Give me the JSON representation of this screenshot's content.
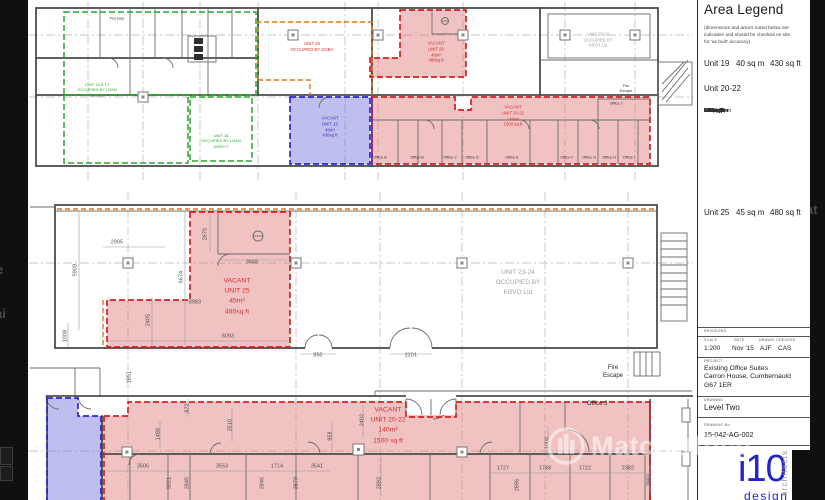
{
  "legend": {
    "title": "Area Legend",
    "disclaimer": "(dimensions and area's noted below are\nindicative and should be checked on site\nfor 'as built' accuracy)",
    "unit19": {
      "name": "Unit 19",
      "sqm": "40 sq m",
      "sqft": "430 sq ft"
    },
    "unit2022_heading": "Unit 20-22",
    "offices": [
      {
        "name": "Office A -",
        "sqm": "10.5 sq m",
        "sqft": "113 sq ft"
      },
      {
        "name": "Office B -",
        "sqm": "10.18 sq m",
        "sqft": "110 sq ft"
      },
      {
        "name": "Office C -",
        "sqm": "4.9 sq m",
        "sqft": "52 sq ft"
      },
      {
        "name": "Office D -",
        "sqm": "10.2 sq m",
        "sqft": "109 sq ft"
      },
      {
        "name": "Office E -",
        "sqm": "15.6 sq m",
        "sqft": "168 sq ft"
      },
      {
        "name": "Office F -",
        "sqm": "5 sq m",
        "sqft": "53 sq ft"
      },
      {
        "name": "Office G -",
        "sqm": "5.16 sq m",
        "sqft": "55 sq ft"
      },
      {
        "name": "Office H -",
        "sqm": "5 sq m",
        "sqft": "53 sq ft"
      },
      {
        "name": "Office I -",
        "sqm": "7.2 sq m",
        "sqft": "77 sq ft"
      },
      {
        "name": "Office J -",
        "sqm": "6.6 sq m",
        "sqft": "71 sq ft"
      }
    ],
    "unit25": {
      "name": "Unit 25",
      "sqm": "45 sq m",
      "sqft": "480 sq ft"
    }
  },
  "title_block": {
    "revisions_label": "REVISIONS",
    "scale_label": "SCALE",
    "scale": "1:200",
    "date_label": "DATE",
    "date": "Nov '15",
    "drawn_label": "DRAWN",
    "drawn": "AJF",
    "checked_label": "CHECKED",
    "checked": "CAS",
    "project_label": "PROJECT",
    "project": "Existing Office Suites\nCarron House, Cumbernauld\nG67 1ER",
    "drawing_label": "DRAWING",
    "drawing": "Level Two",
    "drawing_no_label": "DRAWING No.",
    "drawing_no": "15-042-AG-002"
  },
  "logo": {
    "i10": "i10",
    "design": "design",
    "architects": "architects"
  },
  "watermark": {
    "text": "MatchOffice",
    "icon": "building-circle-icon",
    "fragments": {
      "right": "at",
      "left1": "e",
      "left2": "ai"
    }
  },
  "colors": {
    "vacant_fill": "#e89f9f",
    "vacant_outline": "#d81f1f",
    "occupied_green": "#28a828",
    "blue_fill": "#9f9fe0",
    "blue_outline": "#2828d8",
    "orange_outline": "#e2761b",
    "purple_outline": "#8a1fae",
    "logo_blue": "#2323cd"
  },
  "plan_labels": [
    {
      "name": "unit-16-17-label",
      "cls": "green",
      "x": 97,
      "y": 90,
      "text": "UNIT 16 & 17\nOCCUPIED BY LOAN\nDIRECT"
    },
    {
      "name": "unit-18-label",
      "cls": "green",
      "x": 221,
      "y": 141,
      "text": "UNIT 18\nOCCUPIED BY LOAN\nDIRECT"
    },
    {
      "name": "tea-prep-label",
      "cls": "tiny",
      "x": 117,
      "y": 19,
      "text": "Tea prep"
    },
    {
      "name": "unit-26-label",
      "cls": "red-xs",
      "x": 312,
      "y": 47,
      "text": "UNIT 26\nOCCUPIED BY SOBA"
    },
    {
      "name": "unit-25-overview-label",
      "cls": "red-xs",
      "x": 436,
      "y": 52,
      "text": "VACANT\nUNIT 25\n45m²\n480sq ft"
    },
    {
      "name": "unit-19-overview-label",
      "cls": "blue-xs",
      "x": 330,
      "y": 127,
      "text": "VACANT\nUNIT 19\n40m²\n430sq ft"
    },
    {
      "name": "unit-20-22-overview-label",
      "cls": "red-xs",
      "x": 513,
      "y": 116,
      "text": "VACANT\nUNIT 20-22\n140m²\n1500 sq ft"
    },
    {
      "name": "unit-23-24-overview-label",
      "cls": "grey-xs",
      "x": 598,
      "y": 40,
      "text": "UNIT 23-24\nOCCUPIED BY\nKBVO Ltd"
    },
    {
      "name": "fire-escape-label-top",
      "cls": "tiny",
      "x": 626,
      "y": 89,
      "text": "Fire\nEscape"
    },
    {
      "name": "office-a-label",
      "cls": "tiny",
      "x": 380,
      "y": 158,
      "text": "Office A"
    },
    {
      "name": "office-b-label",
      "cls": "tiny",
      "x": 417,
      "y": 158,
      "text": "Office B"
    },
    {
      "name": "office-c-label",
      "cls": "tiny",
      "x": 450,
      "y": 158,
      "text": "Office C"
    },
    {
      "name": "office-d-label",
      "cls": "tiny",
      "x": 472,
      "y": 158,
      "text": "Office D"
    },
    {
      "name": "office-e-label",
      "cls": "tiny",
      "x": 512,
      "y": 158,
      "text": "Office E"
    },
    {
      "name": "office-f-label",
      "cls": "tiny",
      "x": 567,
      "y": 158,
      "text": "Office F"
    },
    {
      "name": "office-g-label",
      "cls": "tiny",
      "x": 589,
      "y": 158,
      "text": "Office G"
    },
    {
      "name": "office-h-label",
      "cls": "tiny",
      "x": 609,
      "y": 158,
      "text": "Office H"
    },
    {
      "name": "office-i-label",
      "cls": "tiny",
      "x": 629,
      "y": 158,
      "text": "Office I"
    },
    {
      "name": "office-j-overview-label",
      "cls": "tiny",
      "x": 616,
      "y": 104,
      "text": "Office J"
    },
    {
      "cls": "dim",
      "x": 117,
      "y": 243,
      "text": "2905"
    },
    {
      "cls": "dim",
      "x": 76,
      "y": 270,
      "rot": -90,
      "text": "5909"
    },
    {
      "cls": "dim",
      "x": 206,
      "y": 234,
      "rot": -90,
      "text": "2670"
    },
    {
      "cls": "dim",
      "x": 252,
      "y": 263,
      "text": "3668"
    },
    {
      "cls": "dim",
      "x": 182,
      "y": 277,
      "rot": -90,
      "text": "6674"
    },
    {
      "cls": "dim",
      "x": 195,
      "y": 303,
      "text": "8983"
    },
    {
      "cls": "dim",
      "x": 149,
      "y": 320,
      "rot": -90,
      "text": "2405"
    },
    {
      "cls": "dim",
      "x": 66,
      "y": 336,
      "rot": -90,
      "text": "1008"
    },
    {
      "cls": "dim",
      "x": 228,
      "y": 337,
      "text": "6093"
    },
    {
      "name": "unit-25-label",
      "cls": "red-md",
      "x": 237,
      "y": 297,
      "text": "VACANT\nUNIT 25\n45m²\n480sq ft"
    },
    {
      "name": "unit-23-24-label",
      "cls": "grey-md",
      "x": 518,
      "y": 283,
      "text": "UNIT 23-24\nOCCUPIED BY\nKBVO Ltd"
    },
    {
      "cls": "dim",
      "x": 318,
      "y": 356,
      "text": "850"
    },
    {
      "cls": "dim",
      "x": 411,
      "y": 356,
      "text": "2201"
    },
    {
      "name": "fire-escape-label-mid",
      "cls": "blk-sm",
      "x": 613,
      "y": 372,
      "text": "Fire\nEscape"
    },
    {
      "cls": "dim",
      "x": 130,
      "y": 377,
      "rot": -90,
      "text": "1851"
    },
    {
      "cls": "dim",
      "x": 363,
      "y": 420,
      "rot": -90,
      "text": "2492"
    },
    {
      "cls": "dim",
      "x": 188,
      "y": 408,
      "rot": -90,
      "text": "872"
    },
    {
      "cls": "dim",
      "x": 231,
      "y": 425,
      "rot": -90,
      "text": "2510"
    },
    {
      "cls": "dim",
      "x": 159,
      "y": 434,
      "rot": -90,
      "text": "1488"
    },
    {
      "cls": "dim",
      "x": 331,
      "y": 436,
      "rot": -90,
      "text": "959"
    },
    {
      "name": "unit-20-22-label",
      "cls": "red-md",
      "x": 388,
      "y": 426,
      "text": "VACANT\nUNIT 20-22\n140m²\n1500 sq ft"
    },
    {
      "name": "office-j-label",
      "cls": "blk-sm",
      "x": 597,
      "y": 404,
      "text": "Office J"
    },
    {
      "cls": "dim",
      "x": 548,
      "y": 443,
      "rot": -90,
      "text": "1000"
    },
    {
      "cls": "dim",
      "x": 143,
      "y": 467,
      "text": "3506"
    },
    {
      "cls": "dim",
      "x": 170,
      "y": 483,
      "rot": -90,
      "text": "3021"
    },
    {
      "cls": "dim",
      "x": 188,
      "y": 483,
      "rot": -90,
      "text": "2845"
    },
    {
      "cls": "dim",
      "x": 222,
      "y": 467,
      "text": "3553"
    },
    {
      "cls": "dim",
      "x": 263,
      "y": 483,
      "rot": -90,
      "text": "2846"
    },
    {
      "cls": "dim",
      "x": 277,
      "y": 467,
      "text": "1714"
    },
    {
      "cls": "dim",
      "x": 297,
      "y": 483,
      "rot": -90,
      "text": "2879"
    },
    {
      "cls": "dim",
      "x": 317,
      "y": 467,
      "text": "3541"
    },
    {
      "cls": "dim",
      "x": 380,
      "y": 483,
      "rot": -90,
      "text": "2892"
    },
    {
      "cls": "dim",
      "x": 503,
      "y": 469,
      "text": "1727"
    },
    {
      "cls": "dim",
      "x": 518,
      "y": 485,
      "rot": -90,
      "text": "2896"
    },
    {
      "cls": "dim",
      "x": 545,
      "y": 469,
      "text": "1748"
    },
    {
      "cls": "dim",
      "x": 585,
      "y": 469,
      "text": "1722"
    },
    {
      "cls": "dim",
      "x": 628,
      "y": 469,
      "text": "2382"
    },
    {
      "cls": "dim",
      "x": 650,
      "y": 480,
      "rot": -90,
      "text": "3993"
    }
  ]
}
